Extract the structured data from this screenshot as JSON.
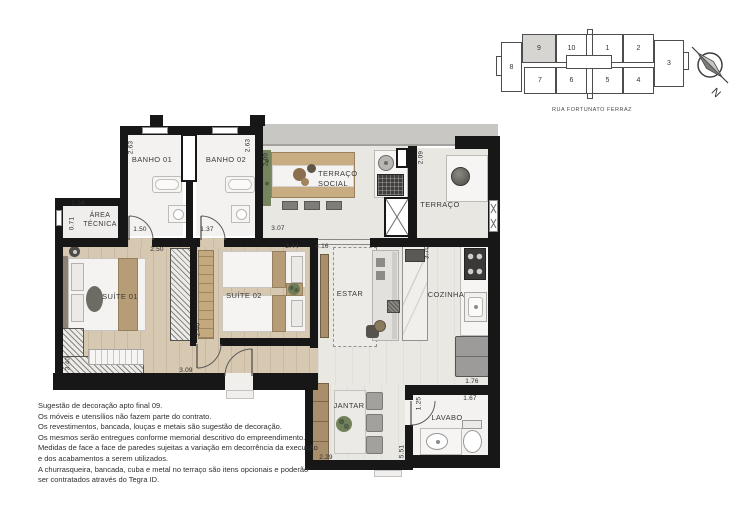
{
  "plan": {
    "rooms": {
      "banho01": "BANHO 01",
      "banho02": "BANHO 02",
      "terraco_social_line1": "TERRAÇO",
      "terraco_social_line2": "SOCIAL",
      "terraco": "TERRAÇO",
      "area_tecnica_line1": "ÁREA",
      "area_tecnica_line2": "TÉCNICA",
      "suite01": "SUÍTE 01",
      "suite02": "SUÍTE 02",
      "estar": "ESTAR",
      "cozinha": "COZINHA",
      "jantar": "JANTAR",
      "lavabo": "LAVABO"
    },
    "dimensions": {
      "banho01_height": "2.63",
      "banho02_height": "2.63",
      "banho01_width": "1.50",
      "banho02_width": "1.37",
      "terraco_social_width": "3.07",
      "terraco_social_height": "2.09",
      "terraco_height": "2.09",
      "area_tecnica_width": "1.34",
      "area_tecnica_height": "0.71",
      "suite01_width": "2.50",
      "suite01_height": "3.40",
      "suite01_bottom": "3.09",
      "closet_height": "2.40",
      "suite02_width": "3.44",
      "estar_width": "4.16",
      "cozinha_height": "3.70",
      "jantar_width": "2.29",
      "jantar_height": "5.51",
      "lavabo_height": "1.25",
      "lavabo_width": "1.67",
      "lavabo_passage": "1.76"
    }
  },
  "keyplan": {
    "street": "RUA FORTUNATO FERRAZ",
    "highlighted_unit": "9",
    "units": [
      {
        "label": "8"
      },
      {
        "label": "9"
      },
      {
        "label": "10"
      },
      {
        "label": "1"
      },
      {
        "label": "2"
      },
      {
        "label": "3"
      },
      {
        "label": "7"
      },
      {
        "label": "6"
      },
      {
        "label": "5"
      },
      {
        "label": "4"
      }
    ]
  },
  "compass": {
    "north_label": "N"
  },
  "disclaimer": {
    "lines": [
      "Sugestão de decoração apto final 09.",
      "Os móveis e utensílios não fazem parte do contrato.",
      "Os revestimentos, bancada, louças e metais são sugestão de decoração.",
      "Os mesmos serão entregues conforme memorial descritivo do empreendimento.",
      "Medidas de face a face de paredes sujeitas a variação em decorrência da execução",
      "e dos acabamentos a serem utilizados.",
      "A churrasqueira, bancada, cuba e metal no terraço são itens opcionais e poderão",
      "ser contratados através do Tegra ID."
    ]
  },
  "colors": {
    "wall": "#171717",
    "wood_floor": "#d6c8b1",
    "tile_floor": "#eae8e3",
    "accent_wood": "#b79c78",
    "keyplan_highlight": "#d7d5d1"
  }
}
